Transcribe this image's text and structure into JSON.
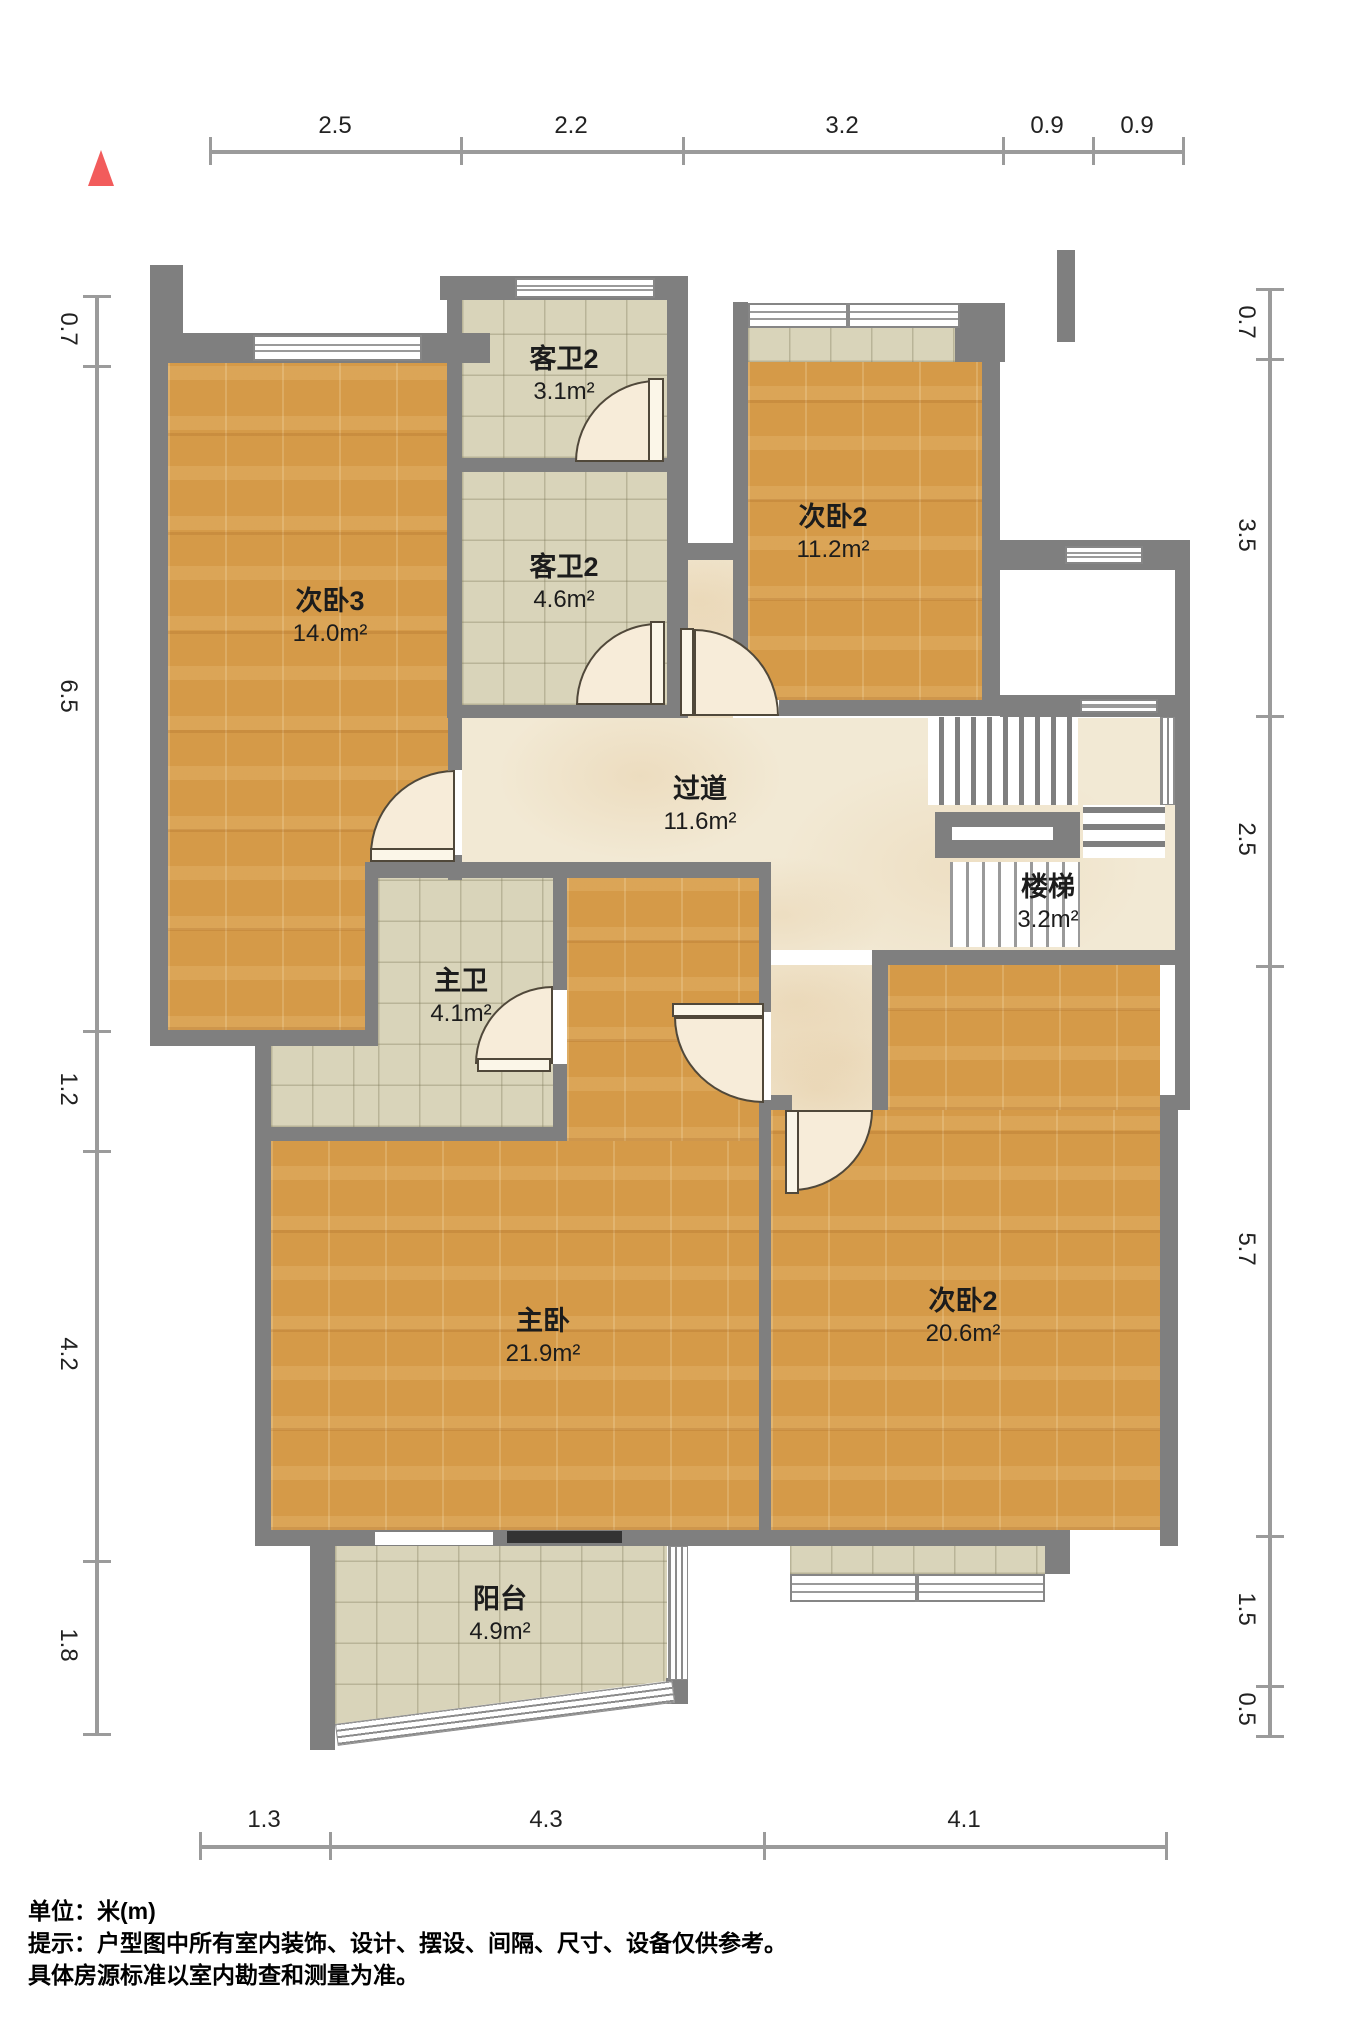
{
  "title": "户型图",
  "colors": {
    "wall": "#7f7f7f",
    "wood_floor": "#d59a48",
    "tile_floor": "#d9d4ba",
    "marble_floor": "#f2e9d4",
    "north_arrow": "#f25c5c",
    "dimension_line": "#9b9b9b"
  },
  "north_icon": "north-arrow",
  "rooms": [
    {
      "name": "次卧3",
      "area": "14.0m²"
    },
    {
      "name": "客卫2",
      "area": "3.1m²"
    },
    {
      "name": "客卫2",
      "area": "4.6m²"
    },
    {
      "name": "次卧2",
      "area": "11.2m²"
    },
    {
      "name": "过道",
      "area": "11.6m²"
    },
    {
      "name": "楼梯",
      "area": "3.2m²"
    },
    {
      "name": "主卫",
      "area": "4.1m²"
    },
    {
      "name": "主卧",
      "area": "21.9m²"
    },
    {
      "name": "次卧2",
      "area": "20.6m²"
    },
    {
      "name": "阳台",
      "area": "4.9m²"
    }
  ],
  "dimensions": {
    "top": [
      "2.5",
      "2.2",
      "3.2",
      "0.9",
      "0.9"
    ],
    "left": [
      "0.7",
      "6.5",
      "1.2",
      "4.2",
      "1.8"
    ],
    "right": [
      "0.7",
      "3.5",
      "2.5",
      "5.7",
      "1.5",
      "0.5"
    ],
    "bottom": [
      "1.3",
      "4.3",
      "4.1"
    ]
  },
  "footer": {
    "unit_line": "单位：米(m)",
    "hint_line": "提示：户型图中所有室内装饰、设计、摆设、间隔、尺寸、设备仅供参考。",
    "note_line": "具体房源标准以室内勘查和测量为准。"
  }
}
